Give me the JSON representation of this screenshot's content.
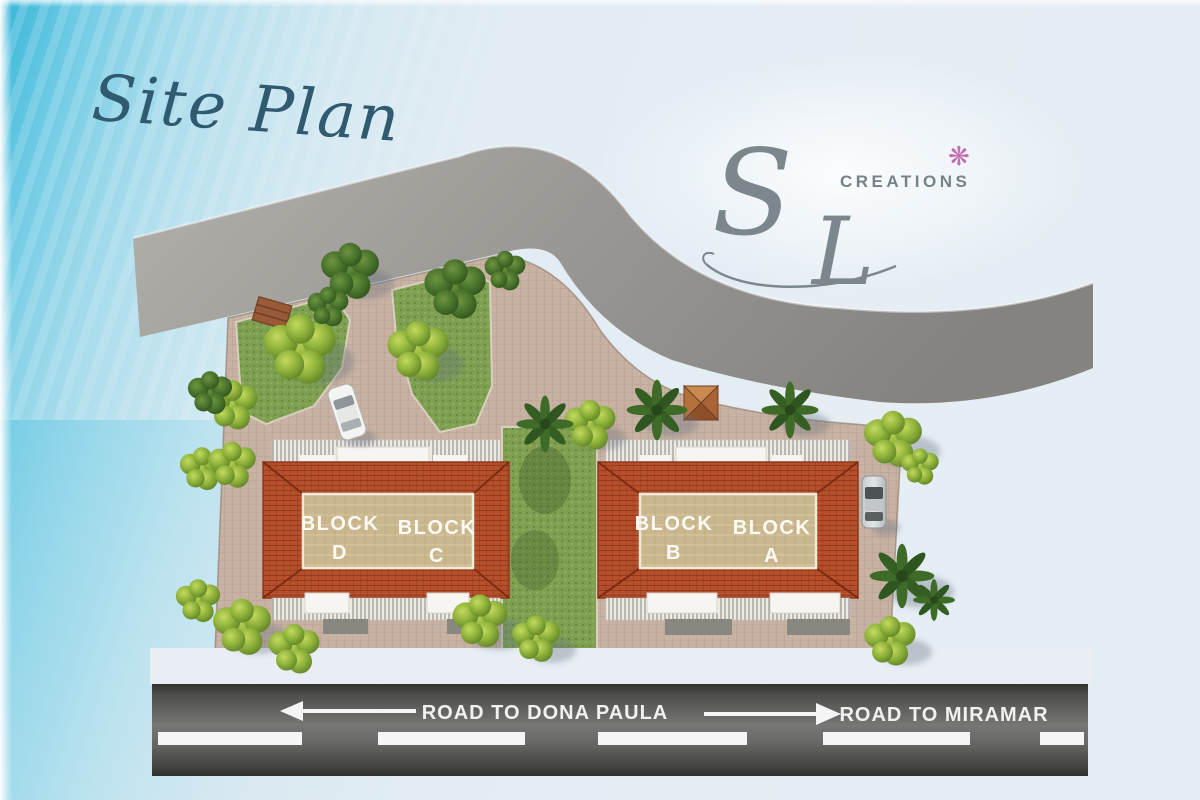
{
  "title": "Site Plan",
  "logo": {
    "letter_s": "S",
    "letter_l": "L",
    "name": "CREATIONS",
    "flower_glyph": "❋"
  },
  "blocks": [
    {
      "word": "BLOCK",
      "letter": "D"
    },
    {
      "word": "BLOCK",
      "letter": "C"
    },
    {
      "word": "BLOCK",
      "letter": "B"
    },
    {
      "word": "BLOCK",
      "letter": "A"
    }
  ],
  "bottom_road": {
    "left_label": "ROAD TO DONA PAULA",
    "right_label": "ROAD TO MIRAMAR"
  },
  "icons": {
    "flower_icon": "❋"
  },
  "colors": {
    "sky_accent": "#45bede",
    "title_teal": "#2f5a70",
    "logo_gray": "#7b868d",
    "flower_pink": "#c56cb0",
    "roof_red": "#b54f2c",
    "courtyard_tan": "#cbb78e",
    "paving_tan": "#c8b2a3",
    "lawn_green": "#7fa050",
    "upper_road_gray": "#9a9895",
    "asphalt_dark": "#4a4a48",
    "marking_white": "#f5f5f5"
  }
}
